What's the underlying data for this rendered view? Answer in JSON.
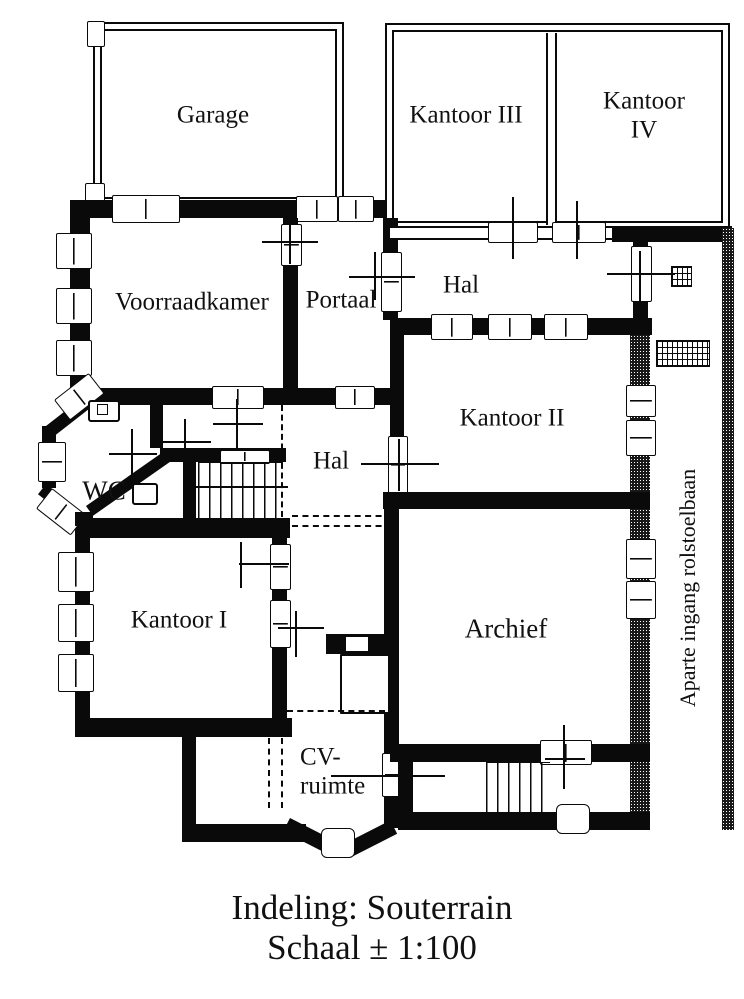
{
  "plan": {
    "rooms": [
      {
        "id": "garage",
        "label": "Garage"
      },
      {
        "id": "kantoor-3",
        "label": "Kantoor III"
      },
      {
        "id": "kantoor-4",
        "label": "Kantoor IV"
      },
      {
        "id": "voorraadkamer",
        "label": "Voorraadkamer"
      },
      {
        "id": "portaal",
        "label": "Portaal"
      },
      {
        "id": "hal-boven",
        "label": "Hal"
      },
      {
        "id": "kantoor-2",
        "label": "Kantoor II"
      },
      {
        "id": "hal-midden",
        "label": "Hal"
      },
      {
        "id": "wc",
        "label": "WC"
      },
      {
        "id": "kantoor-1",
        "label": "Kantoor I"
      },
      {
        "id": "archief",
        "label": "Archief"
      },
      {
        "id": "cv-ruimte",
        "label": "CV-\nruimte"
      }
    ],
    "side_label": "Aparte ingang rolstoelbaan",
    "caption": {
      "line1": "Indeling: Souterrain",
      "line2": "Schaal ± 1:100"
    },
    "colors": {
      "wall": "#0a0a0a",
      "paper": "#ffffff"
    }
  }
}
